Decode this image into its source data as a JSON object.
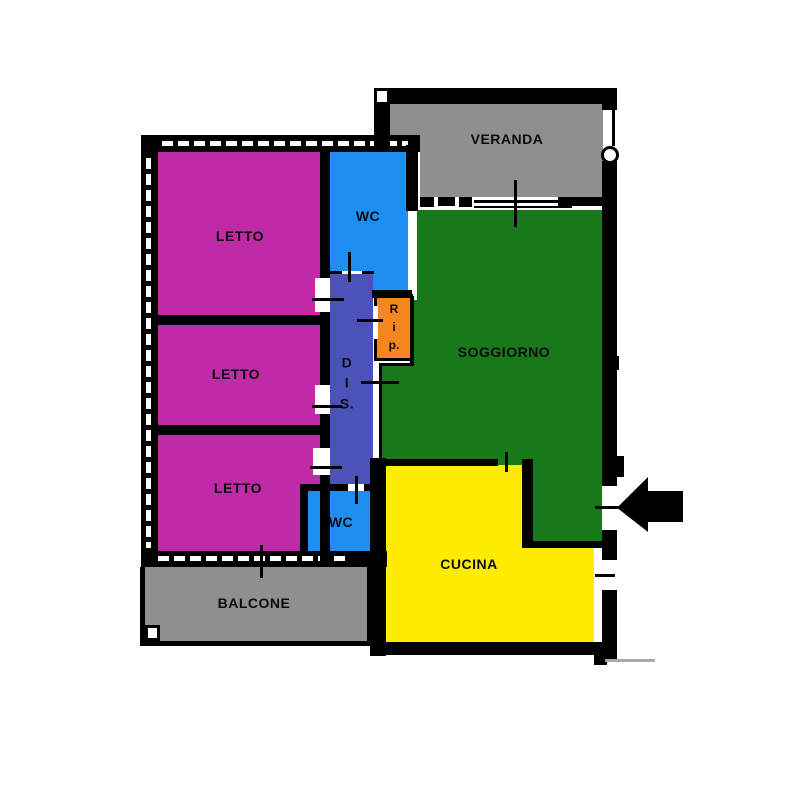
{
  "document": {
    "type": "floor-plan",
    "language": "it"
  },
  "rooms": {
    "letto1": {
      "label": "LETTO"
    },
    "letto2": {
      "label": "LETTO"
    },
    "letto3": {
      "label": "LETTO"
    },
    "wc_top": {
      "label": "WC"
    },
    "wc_bottom": {
      "label": "WC"
    },
    "dis": {
      "label": "D\nI\nS."
    },
    "rip": {
      "label": "R\ni\np."
    },
    "soggiorno": {
      "label": "SOGGIORNO"
    },
    "cucina": {
      "label": "CUCINA"
    },
    "veranda": {
      "label": "VERANDA"
    },
    "balcone": {
      "label": "BALCONE"
    }
  },
  "colors": {
    "wall": "#000000",
    "background": "#ffffff",
    "letto": "#c02aa6",
    "wc": "#1d8ff2",
    "dis": "#4b53bb",
    "rip": "#f6861f",
    "soggiorno": "#17791a",
    "cucina": "#fdec00",
    "veranda": "#8f8f8f",
    "balcone": "#8f8f8f",
    "text": "#0b0b0b",
    "arrow": "#000000",
    "scan_line": "#aaaaaa"
  },
  "icons": {
    "entrance_arrow": "left-pointing-arrow"
  }
}
